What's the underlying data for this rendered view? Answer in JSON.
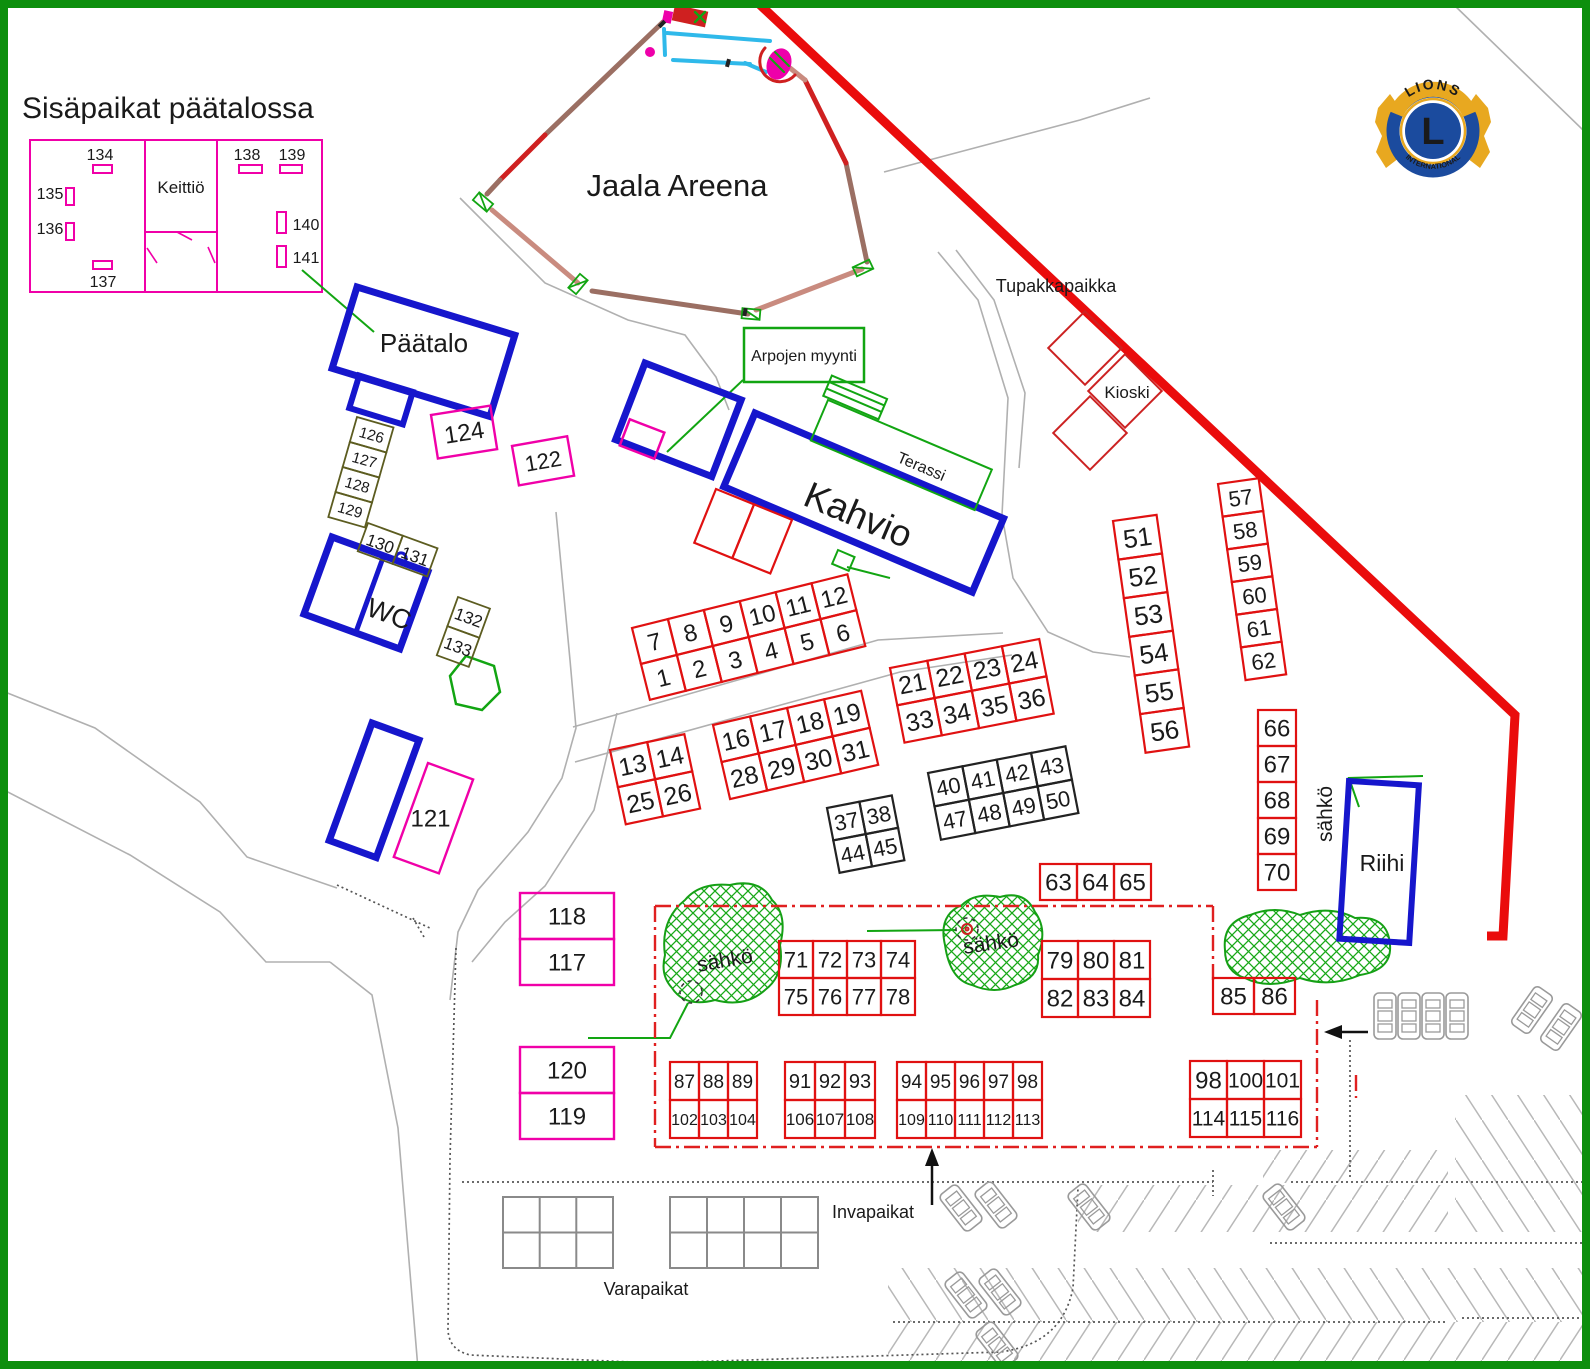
{
  "labels": {
    "title": "Sisäpaikat päätalossa",
    "arena": "Jaala Areena",
    "paatalo": "Päätalo",
    "kahvio": "Kahvio",
    "terassi": "Terassi",
    "arpojen": "Arpojen myynti",
    "tupakkapaikka": "Tupakkapaikka",
    "kioski": "Kioski",
    "wc": "WC",
    "riihi": "Riihi",
    "sahko": "sähkö",
    "invapaikat": "Invapaikat",
    "varapaikat": "Varapaikat",
    "keittio": "Keittiö",
    "lions_name": "LIONS",
    "lions_intl": "INTERNATIONAL",
    "lions_letter": "L"
  },
  "colors": {
    "red": "#e01111",
    "black": "#222222",
    "magenta": "#f000a8",
    "olive": "#5c5c20",
    "blue": "#1616cc",
    "green_line": "#12a512",
    "hatch_green": "#18a818",
    "border_green": "#0d8f0d",
    "boundary_red": "#ea0c0c",
    "road_gray": "#b0b0b0"
  },
  "floorplan": {
    "units": [
      {
        "label": "134",
        "tx": 100,
        "ty": 160,
        "rx": 93,
        "ry": 165,
        "rw": 19,
        "rh": 8
      },
      {
        "label": "135",
        "tx": 50,
        "ty": 199,
        "rx": 66,
        "ry": 188,
        "rw": 8,
        "rh": 17
      },
      {
        "label": "136",
        "tx": 50,
        "ty": 234,
        "rx": 66,
        "ry": 223,
        "rw": 8,
        "rh": 17
      },
      {
        "label": "137",
        "tx": 103,
        "ty": 287,
        "rx": 93,
        "ry": 261,
        "rw": 19,
        "rh": 8
      },
      {
        "label": "138",
        "tx": 247,
        "ty": 160,
        "rx": 239,
        "ry": 165,
        "rw": 23,
        "rh": 8
      },
      {
        "label": "139",
        "tx": 292,
        "ty": 160,
        "rx": 280,
        "ry": 165,
        "rw": 22,
        "rh": 8
      },
      {
        "label": "140",
        "tx": 306,
        "ty": 230,
        "rx": 277,
        "ry": 212,
        "rw": 9,
        "rh": 21
      },
      {
        "label": "141",
        "tx": 306,
        "ty": 263,
        "rx": 277,
        "ry": 246,
        "rw": 9,
        "rh": 21
      }
    ]
  },
  "stall_groups": [
    {
      "name": "1-12",
      "color": "red",
      "x": 632,
      "y": 628,
      "cw": 37,
      "ch": 37,
      "rot": -14,
      "rows": [
        [
          "7",
          "8",
          "9",
          "10",
          "11",
          "12"
        ],
        [
          "1",
          "2",
          "3",
          "4",
          "5",
          "6"
        ]
      ]
    },
    {
      "name": "13-26",
      "color": "red",
      "x": 610,
      "y": 750,
      "cw": 38,
      "ch": 38,
      "rot": -12,
      "rows": [
        [
          "13",
          "14"
        ],
        [
          "25",
          "26"
        ]
      ]
    },
    {
      "name": "16-31",
      "color": "red",
      "x": 713,
      "y": 725,
      "cw": 38,
      "ch": 38,
      "rot": -13,
      "rows": [
        [
          "16",
          "17",
          "18",
          "19"
        ],
        [
          "28",
          "29",
          "30",
          "31"
        ]
      ]
    },
    {
      "name": "21-36",
      "color": "red",
      "x": 890,
      "y": 668,
      "cw": 38,
      "ch": 38,
      "rot": -11,
      "rows": [
        [
          "21",
          "22",
          "23",
          "24"
        ],
        [
          "33",
          "34",
          "35",
          "36"
        ]
      ]
    },
    {
      "name": "37-45",
      "color": "black",
      "x": 827,
      "y": 808,
      "cw": 33,
      "ch": 33,
      "rot": -11,
      "rows": [
        [
          "37",
          "38"
        ],
        [
          "44",
          "45"
        ]
      ]
    },
    {
      "name": "40-50",
      "color": "black",
      "x": 928,
      "y": 773,
      "cw": 35,
      "ch": 34,
      "rot": -11,
      "rows": [
        [
          "40",
          "41",
          "42",
          "43"
        ],
        [
          "47",
          "48",
          "49",
          "50"
        ]
      ]
    },
    {
      "name": "51-56",
      "color": "red",
      "x": 1113,
      "y": 521,
      "cw": 44,
      "ch": 39,
      "rot": -8,
      "rows": [
        [
          "51"
        ],
        [
          "52"
        ],
        [
          "53"
        ],
        [
          "54"
        ],
        [
          "55"
        ],
        [
          "56"
        ]
      ]
    },
    {
      "name": "57-62",
      "color": "red",
      "x": 1218,
      "y": 484,
      "cw": 41,
      "ch": 33,
      "rot": -8,
      "rows": [
        [
          "57"
        ],
        [
          "58"
        ],
        [
          "59"
        ],
        [
          "60"
        ],
        [
          "61"
        ],
        [
          "62"
        ]
      ]
    },
    {
      "name": "66-70",
      "color": "red",
      "x": 1258,
      "y": 710,
      "cw": 38,
      "ch": 36,
      "rot": 0,
      "rows": [
        [
          "66"
        ],
        [
          "67"
        ],
        [
          "68"
        ],
        [
          "69"
        ],
        [
          "70"
        ]
      ]
    },
    {
      "name": "63-65",
      "color": "red",
      "x": 1040,
      "y": 864,
      "cw": 37,
      "ch": 36,
      "rot": 0,
      "rows": [
        [
          "63",
          "64",
          "65"
        ]
      ]
    },
    {
      "name": "71-78",
      "color": "red",
      "x": 779,
      "y": 941,
      "cw": 34,
      "ch": 37,
      "rot": 0,
      "rows": [
        [
          "71",
          "72",
          "73",
          "74"
        ],
        [
          "75",
          "76",
          "77",
          "78"
        ]
      ]
    },
    {
      "name": "79-84",
      "color": "red",
      "x": 1042,
      "y": 941,
      "cw": 36,
      "ch": 38,
      "rot": 0,
      "rows": [
        [
          "79",
          "80",
          "81"
        ],
        [
          "82",
          "83",
          "84"
        ]
      ]
    },
    {
      "name": "85-86",
      "color": "red",
      "x": 1213,
      "y": 978,
      "cw": 41,
      "ch": 36,
      "rot": 0,
      "rows": [
        [
          "85",
          "86"
        ]
      ]
    },
    {
      "name": "87-104",
      "color": "red",
      "x": 670,
      "y": 1062,
      "cw": 29,
      "ch": 38,
      "rot": 0,
      "rows": [
        [
          "87",
          "88",
          "89"
        ],
        [
          "102",
          "103",
          "104"
        ]
      ]
    },
    {
      "name": "91-108",
      "color": "red",
      "x": 785,
      "y": 1062,
      "cw": 30,
      "ch": 38,
      "rot": 0,
      "rows": [
        [
          "91",
          "92",
          "93"
        ],
        [
          "106",
          "107",
          "108"
        ]
      ]
    },
    {
      "name": "94-113",
      "color": "red",
      "x": 897,
      "y": 1062,
      "cw": 29,
      "ch": 38,
      "rot": 0,
      "rows": [
        [
          "94",
          "95",
          "96",
          "97",
          "98"
        ],
        [
          "109",
          "110",
          "111",
          "112",
          "113"
        ]
      ]
    },
    {
      "name": "98-116",
      "color": "red",
      "x": 1190,
      "y": 1061,
      "cw": 37,
      "ch": 38,
      "rot": 0,
      "rows": [
        [
          "98",
          "100",
          "101"
        ],
        [
          "114",
          "115",
          "116"
        ]
      ]
    },
    {
      "name": "117-118",
      "color": "magenta",
      "x": 520,
      "y": 893,
      "cw": 94,
      "ch": 46,
      "rot": 0,
      "rows": [
        [
          "118"
        ],
        [
          "117"
        ]
      ]
    },
    {
      "name": "119-120",
      "color": "magenta",
      "x": 520,
      "y": 1047,
      "cw": 94,
      "ch": 46,
      "rot": 0,
      "rows": [
        [
          "120"
        ],
        [
          "119"
        ]
      ]
    },
    {
      "name": "124",
      "color": "magenta",
      "x": 431,
      "y": 415,
      "cw": 60,
      "ch": 44,
      "rot": -9,
      "rows": [
        [
          "124"
        ]
      ]
    },
    {
      "name": "122",
      "color": "magenta",
      "x": 512,
      "y": 446,
      "cw": 56,
      "ch": 40,
      "rot": -10,
      "rows": [
        [
          "122"
        ]
      ]
    },
    {
      "name": "121",
      "color": "magenta",
      "x": 428,
      "y": 763,
      "cw": 48,
      "ch": 100,
      "rot": 20,
      "textRot": -20,
      "rows": [
        [
          "121"
        ]
      ]
    },
    {
      "name": "126-129",
      "color": "olive",
      "x": 357,
      "y": 417,
      "cw": 38,
      "ch": 26,
      "rot": 16,
      "rows": [
        [
          "126"
        ],
        [
          "127"
        ],
        [
          "128"
        ],
        [
          "129"
        ]
      ]
    },
    {
      "name": "130-131",
      "color": "olive",
      "x": 368,
      "y": 523,
      "cw": 37,
      "ch": 30,
      "rot": 20,
      "rows": [
        [
          "130",
          "131"
        ]
      ]
    },
    {
      "name": "132-133",
      "color": "olive",
      "x": 458,
      "y": 597,
      "cw": 34,
      "ch": 31,
      "rot": 20,
      "rows": [
        [
          "132"
        ],
        [
          "133"
        ]
      ]
    },
    {
      "name": "kahvio-stand",
      "color": "red",
      "x": 716,
      "y": 489,
      "cw": 41,
      "ch": 58,
      "rot": 22,
      "rows": [
        [
          "",
          ""
        ]
      ]
    }
  ],
  "cars": [
    {
      "x": 1385,
      "y": 1016,
      "r": 0
    },
    {
      "x": 1409,
      "y": 1016,
      "r": 0
    },
    {
      "x": 1433,
      "y": 1016,
      "r": 0
    },
    {
      "x": 1457,
      "y": 1016,
      "r": 0
    },
    {
      "x": 1532,
      "y": 1010,
      "r": 35
    },
    {
      "x": 1561,
      "y": 1027,
      "r": 35
    },
    {
      "x": 961,
      "y": 1208,
      "r": -38
    },
    {
      "x": 996,
      "y": 1205,
      "r": -38
    },
    {
      "x": 1089,
      "y": 1207,
      "r": -38
    },
    {
      "x": 1284,
      "y": 1207,
      "r": -38
    },
    {
      "x": 966,
      "y": 1295,
      "r": -38
    },
    {
      "x": 1000,
      "y": 1292,
      "r": -38
    },
    {
      "x": 997,
      "y": 1345,
      "r": -38
    }
  ]
}
